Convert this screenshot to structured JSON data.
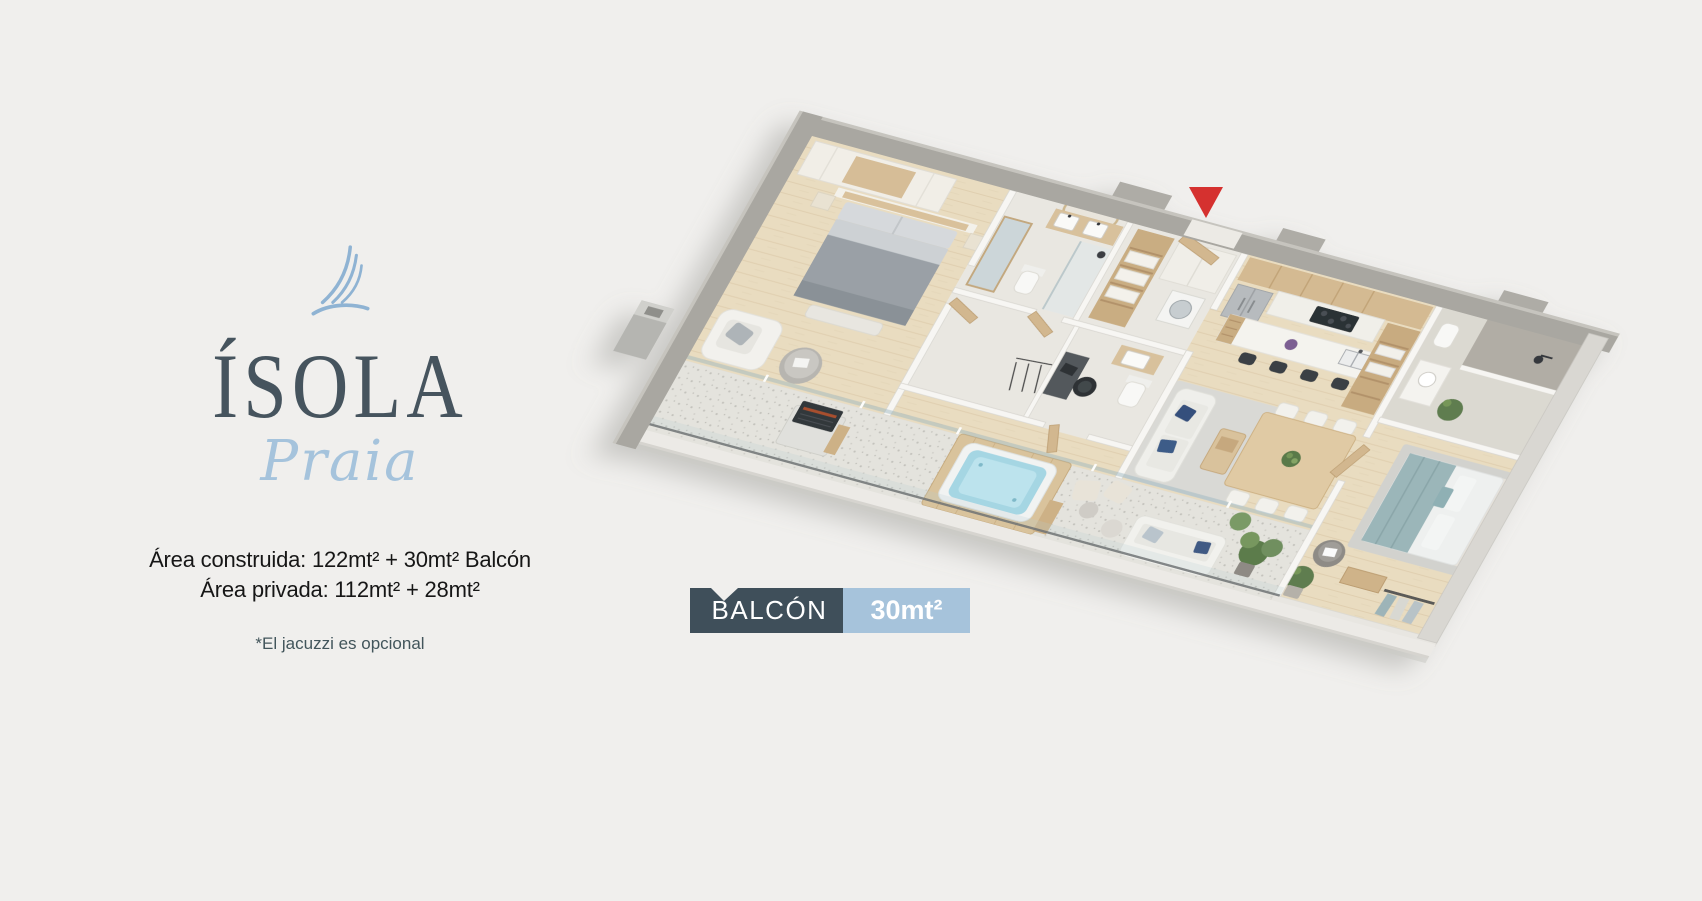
{
  "page": {
    "background_color": "#f0efed"
  },
  "brand": {
    "icon": "sail-icon",
    "title": "ÍSOLA",
    "subtitle": "Praia",
    "title_color": "#46545e",
    "subtitle_color": "#a5c3dc",
    "icon_color": "#8fb3d3"
  },
  "areas": {
    "built": "Área construida: 122mt² + 30mt² Balcón",
    "private": "Área privada: 112mt² + 28mt²",
    "note": "*El jacuzzi es opcional"
  },
  "balcony_tag": {
    "label": "BALCÓN",
    "value": "30mt²",
    "label_bg": "#3f4f5a",
    "value_bg": "#a6c3db",
    "text_color": "#ffffff"
  },
  "floor_plan": {
    "type": "isometric-apartment-3d-render",
    "entrance_marker_color": "#d5312f"
  }
}
